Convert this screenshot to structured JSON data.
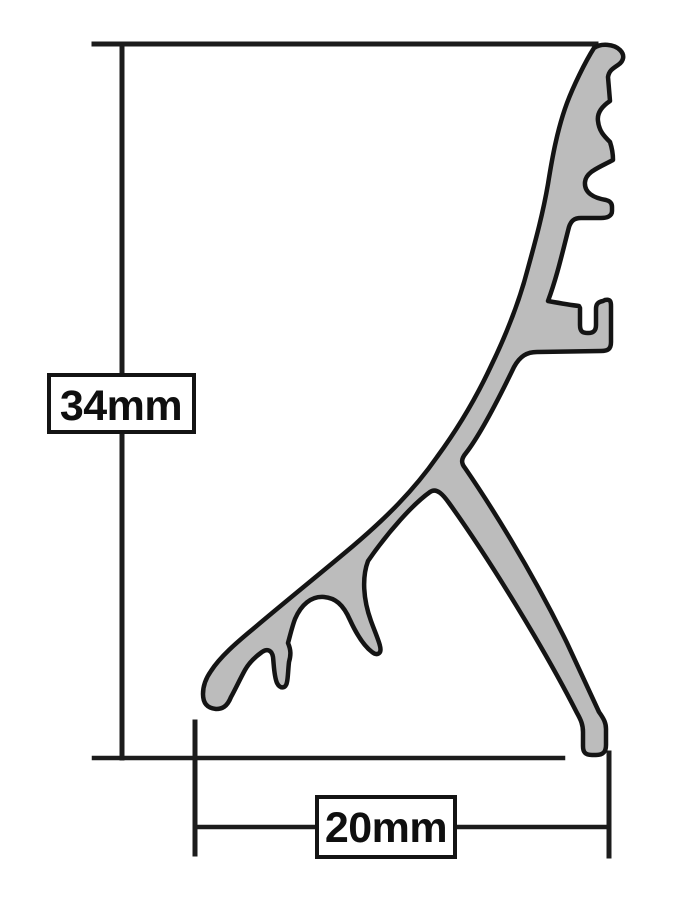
{
  "diagram": {
    "dimensions": {
      "height": {
        "label": "34mm"
      },
      "width": {
        "label": "20mm"
      }
    },
    "colors": {
      "background": "#ffffff",
      "outline": "#141414",
      "profile-fill": "#bcbcbc",
      "dimension-line": "#1c1c1c",
      "label-box-fill": "#ffffff",
      "label-text": "#0f0f0f"
    }
  }
}
